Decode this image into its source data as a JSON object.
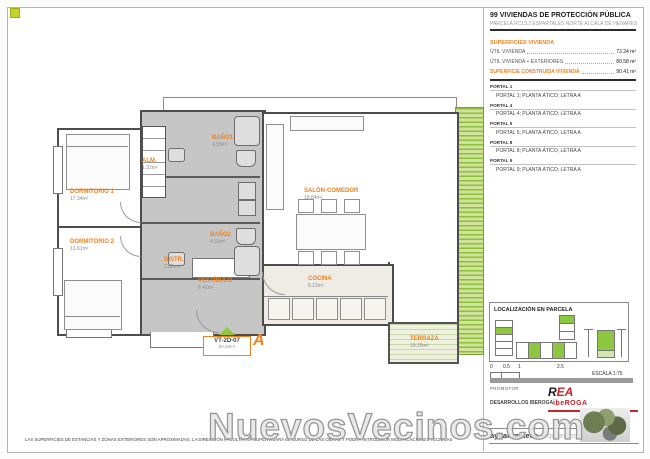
{
  "header": {
    "title": "99 VIVIENDAS DE PROTECCIÓN PÚBLICA",
    "subtitle": "PARCELA RC13.2 ESPARTALES NORTE ALCALÁ DE HENARES"
  },
  "surfaces": {
    "section_title": "SUPERFICIES VIVIENDA",
    "rows": [
      {
        "label": "ÚTIL VIVIENDA",
        "value": "73.24 m²"
      },
      {
        "label": "ÚTIL VIVIENDA + EXTERIORES",
        "value": "80.58 m²"
      }
    ],
    "total_label": "SUPERFICIE CONSTRUIDA VIVIENDA",
    "total_value": "90.41 m²"
  },
  "portales": [
    {
      "header": "PORTAL 1",
      "detail": "PORTAL 1; PLANTA ÁTICO; LETRA A"
    },
    {
      "header": "PORTAL 4",
      "detail": "PORTAL 4; PLANTA ÁTICO; LETRA A"
    },
    {
      "header": "PORTAL 5",
      "detail": "PORTAL 5; PLANTA ÁTICO; LETRA A"
    },
    {
      "header": "PORTAL 8",
      "detail": "PORTAL 8; PLANTA ÁTICO; LETRA A"
    },
    {
      "header": "PORTAL 9",
      "detail": "PORTAL 9; PLANTA ÁTICO; LETRA A"
    }
  ],
  "plan": {
    "rooms": [
      {
        "name": "DORMITORIO 1",
        "area": "17.34m²"
      },
      {
        "name": "DORMITORIO 2",
        "area": "12.61m²"
      },
      {
        "name": "ALM.",
        "area": "1.32m²"
      },
      {
        "name": "BAÑO1",
        "area": "4.55m²"
      },
      {
        "name": "BAÑO2",
        "area": "4.55m²"
      },
      {
        "name": "DISTR.",
        "area": "2.82m²"
      },
      {
        "name": "VESTÍBULO",
        "area": "8.41m²"
      },
      {
        "name": "COCINA",
        "area": "8.12m²"
      },
      {
        "name": "SALÓN-COMEDOR",
        "area": "18.84m²"
      },
      {
        "name": "TERRAZA",
        "area": "19.16m²"
      }
    ],
    "badge": {
      "code": "VT-2D-07",
      "area": "80.58m²",
      "letter": "A"
    }
  },
  "localizacion": {
    "title": "LOCALIZACIÓN EN PARCELA"
  },
  "scale": {
    "ticks": [
      "0",
      "0.5",
      "1",
      "2.5"
    ],
    "label": "ESCALA 1:75"
  },
  "promotor": {
    "label": "PROMOTOR",
    "company": "DESARROLLOS IBEROGA",
    "logo_r": "R",
    "logo_ea": "EA",
    "logo_bottom": "ibeROGA"
  },
  "architect": {
    "name": "aybar mateos",
    "suffix": ".arquitectos"
  },
  "footer": {
    "disclaimer": "LAS SUPERFICIES DE ESTANCIAS Y ZONAS EXTERIORES SON APROXIMADAS, LA DIRECCIÓN FACULTATIVA SUPERVISARÁ EL CURSO DE LAS OBRAS Y PODRÁ INTRODUCIR MODIFICACIONES TÉCNICAS",
    "watermark": "NuevosVecinos.com"
  },
  "colors": {
    "accent_orange": "#f0821e",
    "highlight_green": "#8dc63f",
    "logo_red": "#cc2229"
  }
}
